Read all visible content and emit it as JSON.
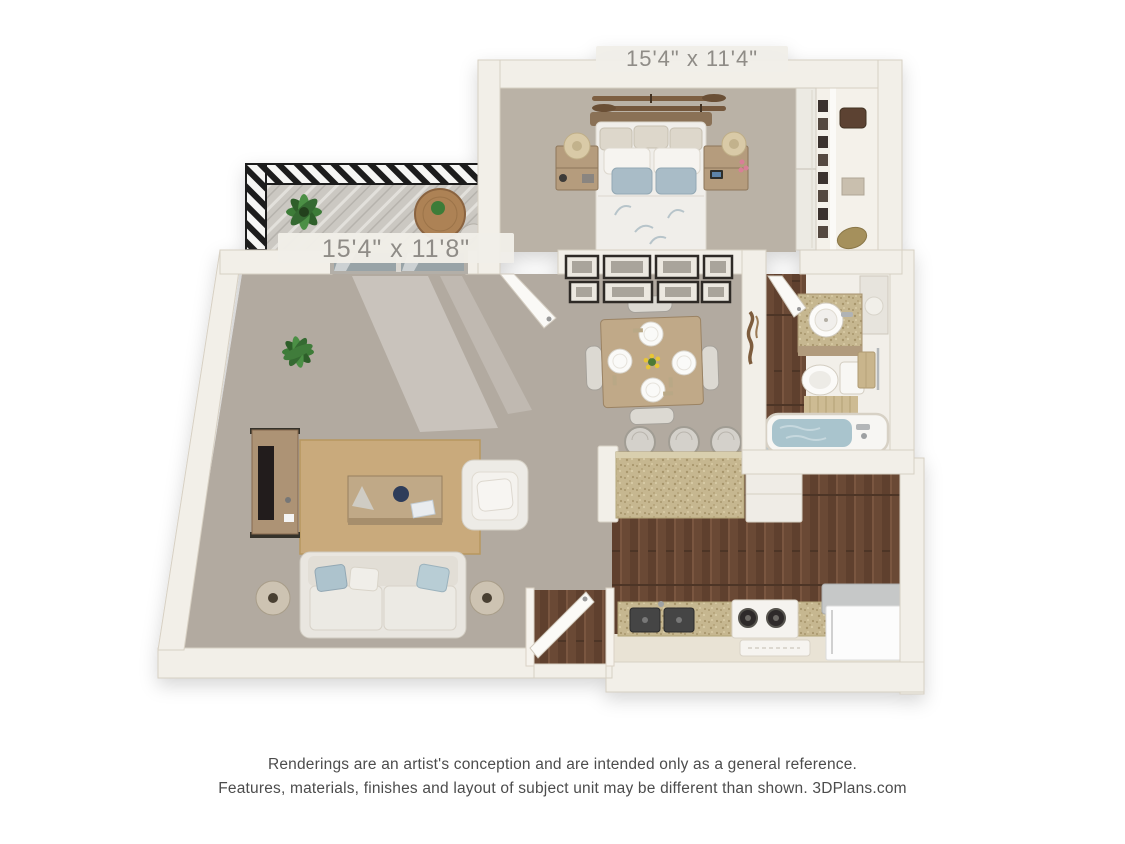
{
  "page": {
    "background": "#ffffff"
  },
  "floorplan": {
    "labels": {
      "bedroom": "15'4\" x 11'4\"",
      "living_room": "15'4\" x 11'8\""
    },
    "rooms": [
      "bedroom",
      "closet",
      "balcony",
      "living-room",
      "dining-area",
      "bathroom",
      "kitchen",
      "entry"
    ],
    "colors": {
      "wall": "#f2efe8",
      "wall_edge": "#d7d0c3",
      "carpet": "#b2aaa0",
      "carpet_bedroom": "#bab2a6",
      "wood_floor": "#6b4a36",
      "rug_jute": "#c9aa7c",
      "granite_counter": "#c6b790",
      "sofa_white": "#e9e6e0",
      "pillow_blue": "#a9bcc7",
      "water_blue": "#a9c4cd",
      "railing_black": "#1f1f1f",
      "plant_green": "#4a8142",
      "label_bg": "#f1eee8",
      "label_text": "#8f8c87",
      "footer_text": "#4c4c4c"
    }
  },
  "footer": {
    "line1": "Renderings are an artist's conception and are intended only as a general reference.",
    "line2": "Features, materials, finishes and layout of subject unit may be different than shown. 3DPlans.com"
  }
}
